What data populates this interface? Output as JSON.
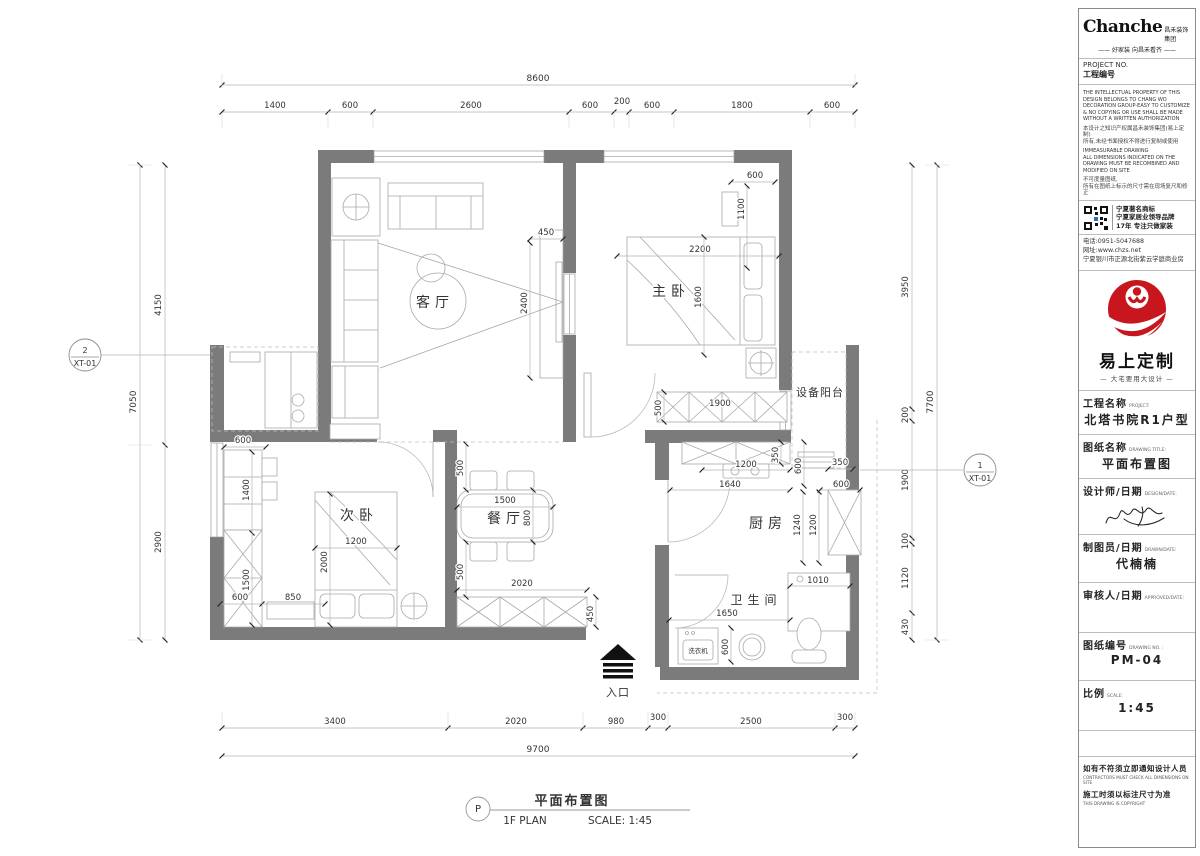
{
  "plan": {
    "rooms": {
      "living": "客厅",
      "master": "主卧",
      "second": "次卧",
      "dining": "餐厅",
      "kitchen": "厨房",
      "bath": "卫生间",
      "balcony": "设备阳台",
      "washer": "洗衣机"
    },
    "entrance_label": "入口",
    "markers": {
      "left": {
        "num": "2",
        "code": "XT-01"
      },
      "right": {
        "num": "1",
        "code": "XT-01"
      }
    },
    "dims": {
      "top_total": "8600",
      "top": [
        "1400",
        "600",
        "2600",
        "600",
        "200",
        "600",
        "1800",
        "600"
      ],
      "bottom": [
        "3400",
        "2020",
        "980",
        "300",
        "2500",
        "300"
      ],
      "bottom_total": "9700",
      "left": [
        "4150",
        "2900"
      ],
      "left_total": "7050",
      "right": [
        "3950",
        "200",
        "1900",
        "100",
        "1120",
        "430"
      ],
      "right_total": "7700",
      "living": [
        "450",
        "2400"
      ],
      "master": [
        "600",
        "1100",
        "2200",
        "1600",
        "1900",
        "500"
      ],
      "second": [
        "600",
        "1400",
        "1500",
        "600",
        "850",
        "1200",
        "2000"
      ],
      "dining": [
        "500",
        "1500",
        "800",
        "500",
        "2020",
        "450"
      ],
      "kitchen": [
        "350",
        "1200",
        "600",
        "1640",
        "350",
        "600",
        "1240",
        "1200"
      ],
      "bath": [
        "1650",
        "600",
        "1010"
      ]
    },
    "caption": {
      "bubble": "P",
      "title": "平面布置图",
      "plan_name": "1F PLAN",
      "scale": "SCALE: 1:45"
    }
  },
  "titleblock": {
    "brand": "Chanche",
    "brand_cn": "昌禾装饰集团",
    "slogan": "—— 好家装 向昌禾看齐 ——",
    "project_no_en": "PROJECT NO.",
    "project_no_cn": "工程编号",
    "legal_en1": "THE INTELLECTUAL PROPERTY OF THIS\nDESIGN BELONGS TO CHANG WO\nDECORATION GROUP-EASY TO CUSTOMIZE\n& NO COPYING OR USE SHALL BE MADE\nWITHOUT A WRITTEN AUTHORIZATION",
    "legal_cn1": "本设计之知识产权属昌禾装饰集团(易上定制)\n所有,未经书面授权不得进行复制或使用",
    "legal_en2": "IMMEASURABLE DRAWING\nALL DIMENSIONS INDICATED ON THE\nDRAWING MUST BE RECOMBINED AND\nMODIFIED ON SITE",
    "legal_cn2": "不可度量图纸,\n所有在图纸上标示的尺寸需在现场复尺和修正",
    "qr_line1": "宁夏著名商标",
    "qr_line2": "宁夏家居业领导品牌",
    "qr_line3": "17年 专注只做家装",
    "phone": "电话:0951-5047688",
    "website": "网址:www.chzs.net",
    "address": "宁夏银川市正源北街紫云学庭商业房",
    "logo_name": "易上定制",
    "logo_tagline": "— 大宅要用大设计 —",
    "fields": {
      "project": {
        "cn": "工程名称",
        "en": "PROJECT:",
        "value": "北塔书院R1户型"
      },
      "drawing": {
        "cn": "图纸名称",
        "en": "DRAWING TITLE:",
        "value": "平面布置图"
      },
      "designer": {
        "cn": "设计师/日期",
        "en": "DESIGN/DATE:"
      },
      "drafter": {
        "cn": "制图员/日期",
        "en": "DRAWN/DATE:",
        "value": "代楠楠"
      },
      "approver": {
        "cn": "审核人/日期",
        "en": "APPROVED/DATE:",
        "value": ""
      },
      "number": {
        "cn": "图纸编号",
        "en": "DRAWING NO. :",
        "value": "PM-04"
      },
      "scale": {
        "cn": "比例",
        "en": "SCALE:",
        "value": "1:45"
      }
    },
    "notes": {
      "cn1": "如有不符须立即通知设计人员",
      "en1": "CONTRACTORS MUST CHECK ALL DIMENSIONS ON SITE",
      "cn2": "施工时须以标注尺寸为准",
      "en2": "THIS DRAWING IS COPYRIGHT"
    }
  }
}
